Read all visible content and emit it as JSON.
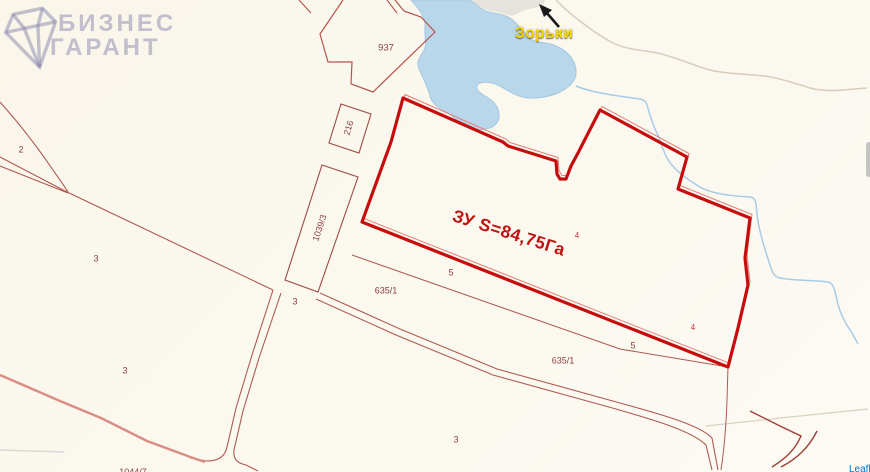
{
  "watermark": {
    "line1": "БИЗНЕС",
    "line2": "ГАРАНТ"
  },
  "place": {
    "name": "Зорьки"
  },
  "main_parcel": {
    "label": "ЗУ S=84,75Га",
    "area": "S=84,75Га"
  },
  "labels": [
    {
      "id": "parcel-2",
      "text": "2"
    },
    {
      "id": "parcel-3-a",
      "text": "3"
    },
    {
      "id": "parcel-3-b",
      "text": "3"
    },
    {
      "id": "parcel-3-c",
      "text": "3"
    },
    {
      "id": "parcel-3-d",
      "text": "3"
    },
    {
      "id": "parcel-937",
      "text": "937"
    },
    {
      "id": "parcel-216",
      "text": "216"
    },
    {
      "id": "parcel-1039-3",
      "text": "1039/3"
    },
    {
      "id": "parcel-635-1-a",
      "text": "635/1"
    },
    {
      "id": "parcel-635-1-b",
      "text": "635/1"
    },
    {
      "id": "parcel-5-a",
      "text": "5"
    },
    {
      "id": "parcel-5-b",
      "text": "5"
    },
    {
      "id": "parcel-4-a",
      "text": "4"
    },
    {
      "id": "parcel-4-b",
      "text": "4"
    },
    {
      "id": "parcel-1044-7",
      "text": "1044/7"
    }
  ],
  "attribution": {
    "text": "Leaflet"
  },
  "colors": {
    "selected_parcel_outline": "#c60d0d",
    "cadastral_line": "#b05a52",
    "water_fill": "#b9d7eb",
    "place_label": "#f5d500",
    "road_pink": "#d98d85",
    "watermark": "#8482ac"
  }
}
